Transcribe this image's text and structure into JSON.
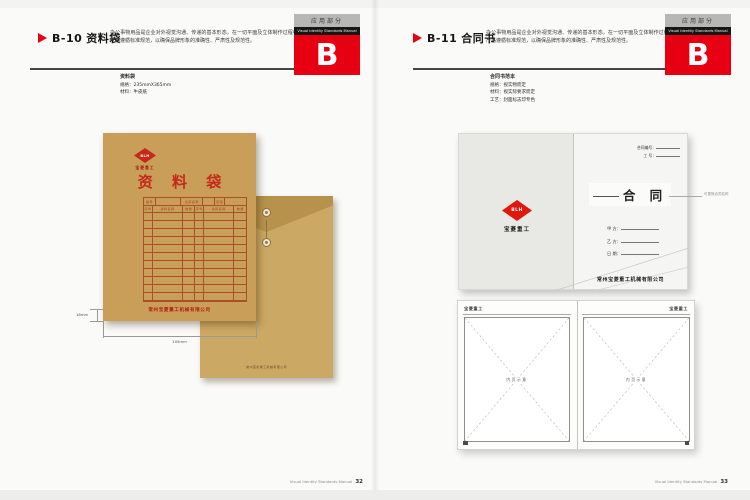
{
  "manual_footer": {
    "label": "Visual Identity Standards Manual",
    "left_page_no": "32",
    "right_page_no": "33"
  },
  "left_page": {
    "code": "B-10",
    "title": "资料袋",
    "desc": "办公事物用品是企业对外视觉沟通、传递的基本形态，在一切平面及立体制作过程中都应严格遵循标准规范，以确保品牌形象的准确性、严肃性及规范性。",
    "tab": {
      "section": "应用部分",
      "manual": "Visual Identity Standards Manual",
      "letter": "B"
    },
    "spec": {
      "title": "资料袋",
      "line1": "规格：235mmX365mm",
      "line2": "材料：牛皮纸"
    },
    "envelope_front": {
      "logo_letters": "BLH",
      "logo_caption": "宝菱重工",
      "big_title": "资 料 袋",
      "table_header": [
        "编号",
        "",
        "全宗名称",
        "",
        "密级",
        ""
      ],
      "table_sub": [
        "序号",
        "资料名称",
        "数量",
        "序号",
        "资料名称",
        "数量"
      ],
      "blank_rows": 11,
      "company": "常州宝菱重工机械有限公司"
    },
    "envelope_back": {
      "imprint": "常州宝菱重工机械有限公司"
    },
    "dims": {
      "side": "18mm",
      "bottom": "105mm"
    }
  },
  "right_page": {
    "code": "B-11",
    "title": "合同书",
    "desc": "办公事物用品是企业对外视觉沟通、传递的基本形态，在一切平面及立体制作过程中都应严格遵循标准规范，以确保品牌形象的准确性、严肃性及规范性。",
    "tab": {
      "section": "应用部分",
      "manual": "Visual Identity Standards Manual",
      "letter": "B"
    },
    "spec": {
      "title": "合同书范本",
      "line1": "规格：视实物而定",
      "line2": "材料：视实际要求而定",
      "line3": "工艺：封面标志印专色"
    },
    "cover": {
      "no_label": "合同编号：",
      "serial_label": "工  号：",
      "title": "合  同",
      "annotation": "可更换合同名称",
      "party_a": "甲 方：",
      "party_b": "乙 方：",
      "date_label": "日 期：",
      "company": "常州宝菱重工机械有限公司",
      "logo_letters": "BLH",
      "logo_caption": "宝菱重工"
    },
    "inner_pages": {
      "brand": "宝菱重工",
      "placeholder": "内页示意"
    }
  }
}
